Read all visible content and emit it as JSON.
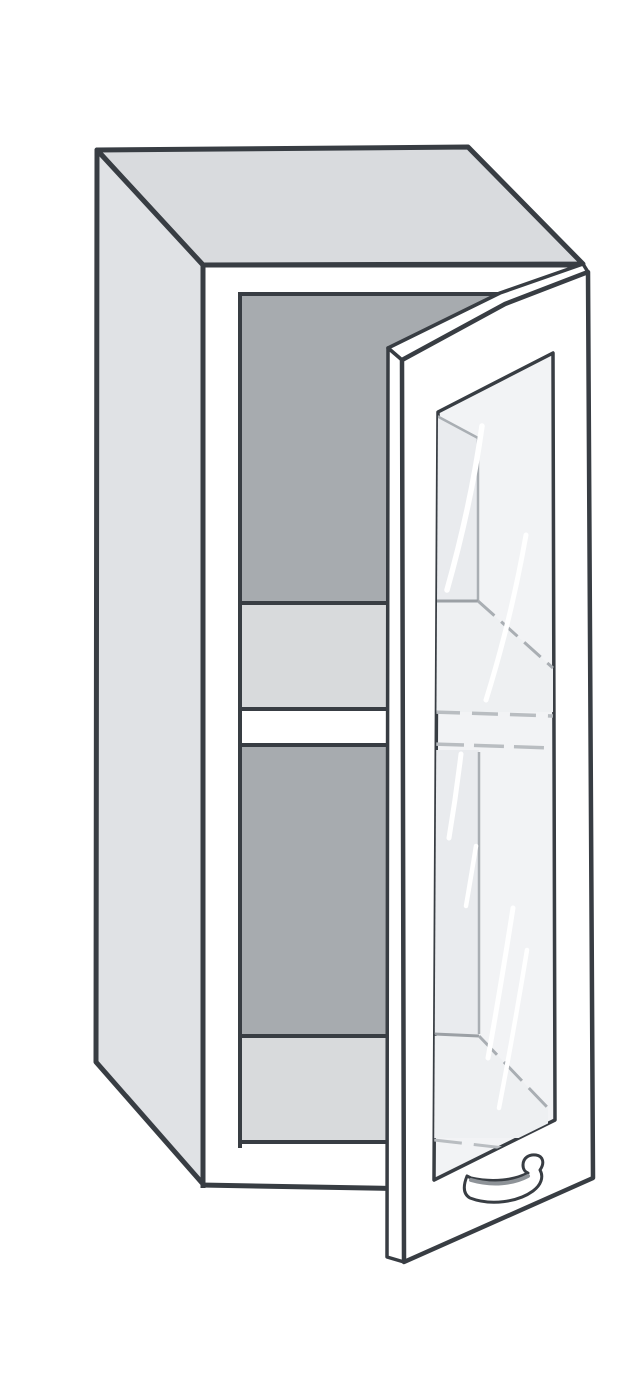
{
  "illustration": {
    "canvas": {
      "width": 640,
      "height": 1400,
      "background": "#ffffff"
    },
    "palette": {
      "outline": "#383d43",
      "top_face": "#d9dbde",
      "side_face": "#e0e2e5",
      "front_face": "#ffffff",
      "interior_back": "#a7abaf",
      "shelf_surface": "#d8dadc",
      "glass": "#f2f3f5",
      "glass_tint": "#e9ebee",
      "glass_tint_light": "#eef0f2",
      "through_glass_line": "#a9aeb3",
      "reflection": "#ffffff"
    },
    "clips": [
      {
        "id": "clip-opening",
        "points": "240,292 502,292 388,351 388,1150 240,1150"
      },
      {
        "id": "clip-glass",
        "points": "438,412 553,353 555,1120 434,1180"
      }
    ],
    "shapes": [
      {
        "name": "cabinet-top-face",
        "type": "polygon",
        "points": "97,150 468,147 583,264 203,265",
        "fill": "#d9dbde",
        "stroke": "#383d43",
        "sw": 5
      },
      {
        "name": "cabinet-left-side",
        "type": "polygon",
        "points": "97,150 203,265 203,1184 96,1062",
        "fill": "#e0e2e5",
        "stroke": "#383d43",
        "sw": 5
      },
      {
        "name": "cabinet-front-frame",
        "type": "polygon",
        "points": "203,265 583,265 593,1180 203,1186",
        "fill": "#ffffff"
      },
      {
        "name": "interior-back-panel-upper",
        "type": "rect",
        "x": 230,
        "y": 288,
        "w": 292,
        "h": 317,
        "fill": "#a7abaf",
        "clip": "clip-opening"
      },
      {
        "name": "interior-shelf-top-surface",
        "type": "rect",
        "x": 230,
        "y": 601,
        "w": 292,
        "h": 110,
        "fill": "#d8dadc",
        "clip": "clip-opening"
      },
      {
        "name": "interior-shelf-front-edge",
        "type": "rect",
        "x": 230,
        "y": 711,
        "w": 292,
        "h": 35,
        "fill": "#ffffff",
        "clip": "clip-opening"
      },
      {
        "name": "interior-back-panel-lower",
        "type": "rect",
        "x": 230,
        "y": 746,
        "w": 292,
        "h": 290,
        "fill": "#a7abaf",
        "clip": "clip-opening"
      },
      {
        "name": "interior-floor-surface",
        "type": "rect",
        "x": 230,
        "y": 1036,
        "w": 292,
        "h": 106,
        "fill": "#d8dadc",
        "clip": "clip-opening"
      },
      {
        "name": "interior-bottom-rail",
        "type": "rect",
        "x": 230,
        "y": 1142,
        "w": 292,
        "h": 10,
        "fill": "#ffffff",
        "clip": "clip-opening"
      },
      {
        "name": "interior-shelf-top-line",
        "type": "line",
        "x1": 236,
        "y1": 603,
        "x2": 391,
        "y2": 603,
        "stroke": "#383d43",
        "sw": 4,
        "clip": "clip-opening"
      },
      {
        "name": "interior-shelf-front-top-line",
        "type": "line",
        "x1": 236,
        "y1": 709,
        "x2": 391,
        "y2": 709,
        "stroke": "#383d43",
        "sw": 4,
        "clip": "clip-opening"
      },
      {
        "name": "interior-shelf-front-bottom-line",
        "type": "line",
        "x1": 236,
        "y1": 745,
        "x2": 391,
        "y2": 745,
        "stroke": "#383d43",
        "sw": 4,
        "clip": "clip-opening"
      },
      {
        "name": "interior-floor-top-line",
        "type": "line",
        "x1": 236,
        "y1": 1036,
        "x2": 391,
        "y2": 1036,
        "stroke": "#383d43",
        "sw": 4,
        "clip": "clip-opening"
      },
      {
        "name": "interior-floor-front-line",
        "type": "line",
        "x1": 236,
        "y1": 1142,
        "x2": 391,
        "y2": 1142,
        "stroke": "#383d43",
        "sw": 4,
        "clip": "clip-opening"
      },
      {
        "name": "interior-opening-top-edge",
        "type": "path",
        "d": "M238,294 L500,294 L388,352",
        "fill": "none",
        "stroke": "#383d43",
        "sw": 4
      },
      {
        "name": "interior-opening-left-edge",
        "type": "line",
        "x1": 240,
        "y1": 292,
        "x2": 240,
        "y2": 1148,
        "stroke": "#383d43",
        "sw": 4
      },
      {
        "name": "cabinet-front-top-edge",
        "type": "line",
        "x1": 201,
        "y1": 265,
        "x2": 585,
        "y2": 265,
        "stroke": "#383d43",
        "sw": 5
      },
      {
        "name": "cabinet-front-left-edge",
        "type": "line",
        "x1": 203,
        "y1": 263,
        "x2": 203,
        "y2": 1188,
        "stroke": "#383d43",
        "sw": 5
      },
      {
        "name": "cabinet-front-bottom-edge",
        "type": "line",
        "x1": 201,
        "y1": 1185,
        "x2": 420,
        "y2": 1189,
        "stroke": "#383d43",
        "sw": 5
      },
      {
        "name": "door-top-edge-face",
        "type": "path",
        "d": "M388,348 L500,293 L583,264 L588,272 L505,304 L402,360 Z",
        "fill": "#ffffff",
        "stroke": "#383d43",
        "sw": 3.5
      },
      {
        "name": "door-left-edge-face",
        "type": "polygon",
        "points": "388,348 402,360 404,1262 387,1257",
        "fill": "#ffffff",
        "stroke": "#383d43",
        "sw": 3.5
      },
      {
        "name": "door-front-face",
        "type": "path",
        "d": "M402,360 L505,304 L588,272 L593,1178 L404,1262 Z",
        "fill": "#ffffff",
        "stroke": "#383d43",
        "sw": 4.5
      },
      {
        "name": "door-glass-panel",
        "type": "polygon",
        "points": "438,412 553,353 555,1120 434,1180",
        "fill": "#f2f3f5",
        "stroke": "#383d43",
        "sw": 3.5
      },
      {
        "name": "glass-view-back-panel-upper",
        "type": "polygon",
        "points": "434,414 478,438 478,601 434,601",
        "fill": "#e9ebee",
        "clip": "clip-glass"
      },
      {
        "name": "glass-view-top-corner-line",
        "type": "line",
        "x1": 435,
        "y1": 415,
        "x2": 478,
        "y2": 438,
        "stroke": "#a9aeb3",
        "sw": 2.5,
        "clip": "clip-glass"
      },
      {
        "name": "glass-view-wall-corner-line-upper",
        "type": "line",
        "x1": 478,
        "y1": 438,
        "x2": 478,
        "y2": 601,
        "stroke": "#a9aeb3",
        "sw": 2.5,
        "clip": "clip-glass"
      },
      {
        "name": "glass-view-shelf-surface",
        "type": "polygon",
        "points": "434,601 478,601 553,668 553,712 434,712",
        "fill": "#eef0f2",
        "clip": "clip-glass"
      },
      {
        "name": "glass-view-shelf-top-line",
        "type": "line",
        "x1": 434,
        "y1": 601,
        "x2": 478,
        "y2": 601,
        "stroke": "#9ba0a5",
        "sw": 3,
        "clip": "clip-glass"
      },
      {
        "name": "glass-view-shelf-wall-line",
        "type": "line",
        "x1": 478,
        "y1": 601,
        "x2": 553,
        "y2": 668,
        "stroke": "#a9aeb3",
        "sw": 3,
        "dash": "22 9",
        "clip": "clip-glass"
      },
      {
        "name": "glass-view-shelf-front-line-1",
        "type": "line",
        "x1": 434,
        "y1": 712,
        "x2": 553,
        "y2": 716,
        "stroke": "#b9bdc1",
        "sw": 3.5,
        "dash": "26 12",
        "clip": "clip-glass"
      },
      {
        "name": "glass-view-shelf-front-line-2",
        "type": "line",
        "x1": 434,
        "y1": 744,
        "x2": 553,
        "y2": 748,
        "stroke": "#b9bdc1",
        "sw": 3.5,
        "dash": "30 10",
        "clip": "clip-glass"
      },
      {
        "name": "glass-view-back-panel-lower",
        "type": "polygon",
        "points": "434,750 479,750 479,1034 434,1034",
        "fill": "#e9ebee",
        "clip": "clip-glass"
      },
      {
        "name": "glass-view-wall-corner-line-lower",
        "type": "line",
        "x1": 479,
        "y1": 752,
        "x2": 479,
        "y2": 1034,
        "stroke": "#a9aeb3",
        "sw": 2.5,
        "clip": "clip-glass"
      },
      {
        "name": "glass-view-floor-surface",
        "type": "polygon",
        "points": "434,1036 479,1036 548,1108 548,1138 434,1138",
        "fill": "#eef0f2",
        "clip": "clip-glass"
      },
      {
        "name": "glass-view-floor-top-line",
        "type": "line",
        "x1": 434,
        "y1": 1034,
        "x2": 479,
        "y2": 1036,
        "stroke": "#9ba0a5",
        "sw": 3,
        "clip": "clip-glass"
      },
      {
        "name": "glass-view-floor-wall-line",
        "type": "line",
        "x1": 479,
        "y1": 1036,
        "x2": 548,
        "y2": 1108,
        "stroke": "#a9aeb3",
        "sw": 3,
        "dash": "26 10",
        "clip": "clip-glass"
      },
      {
        "name": "glass-view-bottom-rail-line",
        "type": "line",
        "x1": 434,
        "y1": 1140,
        "x2": 522,
        "y2": 1150,
        "stroke": "#b9bdc1",
        "sw": 3,
        "dash": "28 12",
        "clip": "clip-glass"
      },
      {
        "name": "glass-reflection-streak-1",
        "type": "path",
        "d": "M482,426 Q471,505 447,590",
        "fill": "none",
        "stroke": "#ffffff",
        "sw": 5.5,
        "cap": "round",
        "clip": "clip-glass"
      },
      {
        "name": "glass-reflection-streak-2",
        "type": "path",
        "d": "M526,535 Q511,620 486,700",
        "fill": "none",
        "stroke": "#ffffff",
        "sw": 5,
        "cap": "round",
        "clip": "clip-glass"
      },
      {
        "name": "glass-reflection-streak-3",
        "type": "path",
        "d": "M461,754 Q456,796 449,838",
        "fill": "none",
        "stroke": "#ffffff",
        "sw": 5,
        "cap": "round",
        "clip": "clip-glass"
      },
      {
        "name": "glass-reflection-streak-4",
        "type": "path",
        "d": "M476,846 Q471,877 466,906",
        "fill": "none",
        "stroke": "#ffffff",
        "sw": 4.5,
        "cap": "round",
        "clip": "clip-glass"
      },
      {
        "name": "glass-reflection-streak-5",
        "type": "path",
        "d": "M513,908 Q501,985 488,1058",
        "fill": "none",
        "stroke": "#ffffff",
        "sw": 5,
        "cap": "round",
        "clip": "clip-glass"
      },
      {
        "name": "glass-reflection-streak-6",
        "type": "path",
        "d": "M527,950 Q514,1030 499,1108",
        "fill": "none",
        "stroke": "#ffffff",
        "sw": 4.5,
        "cap": "round",
        "clip": "clip-glass"
      },
      {
        "name": "door-handle",
        "type": "path",
        "d": "M467,1176 C463,1186 463,1194 470,1198 C491,1206 518,1202 533,1191 C541,1185 544,1177 540,1170 C545,1163 543,1156 536,1155 C529,1154 523,1158 523,1165 C523,1169 525,1172 528,1173 C515,1180 493,1183 471,1178 Z",
        "fill": "#ffffff",
        "stroke": "#383d43",
        "sw": 3
      },
      {
        "name": "door-handle-shade-line",
        "type": "path",
        "d": "M471,1180 C492,1186 513,1184 528,1176",
        "fill": "none",
        "stroke": "#8e9398",
        "sw": 4,
        "cap": "round"
      }
    ]
  }
}
